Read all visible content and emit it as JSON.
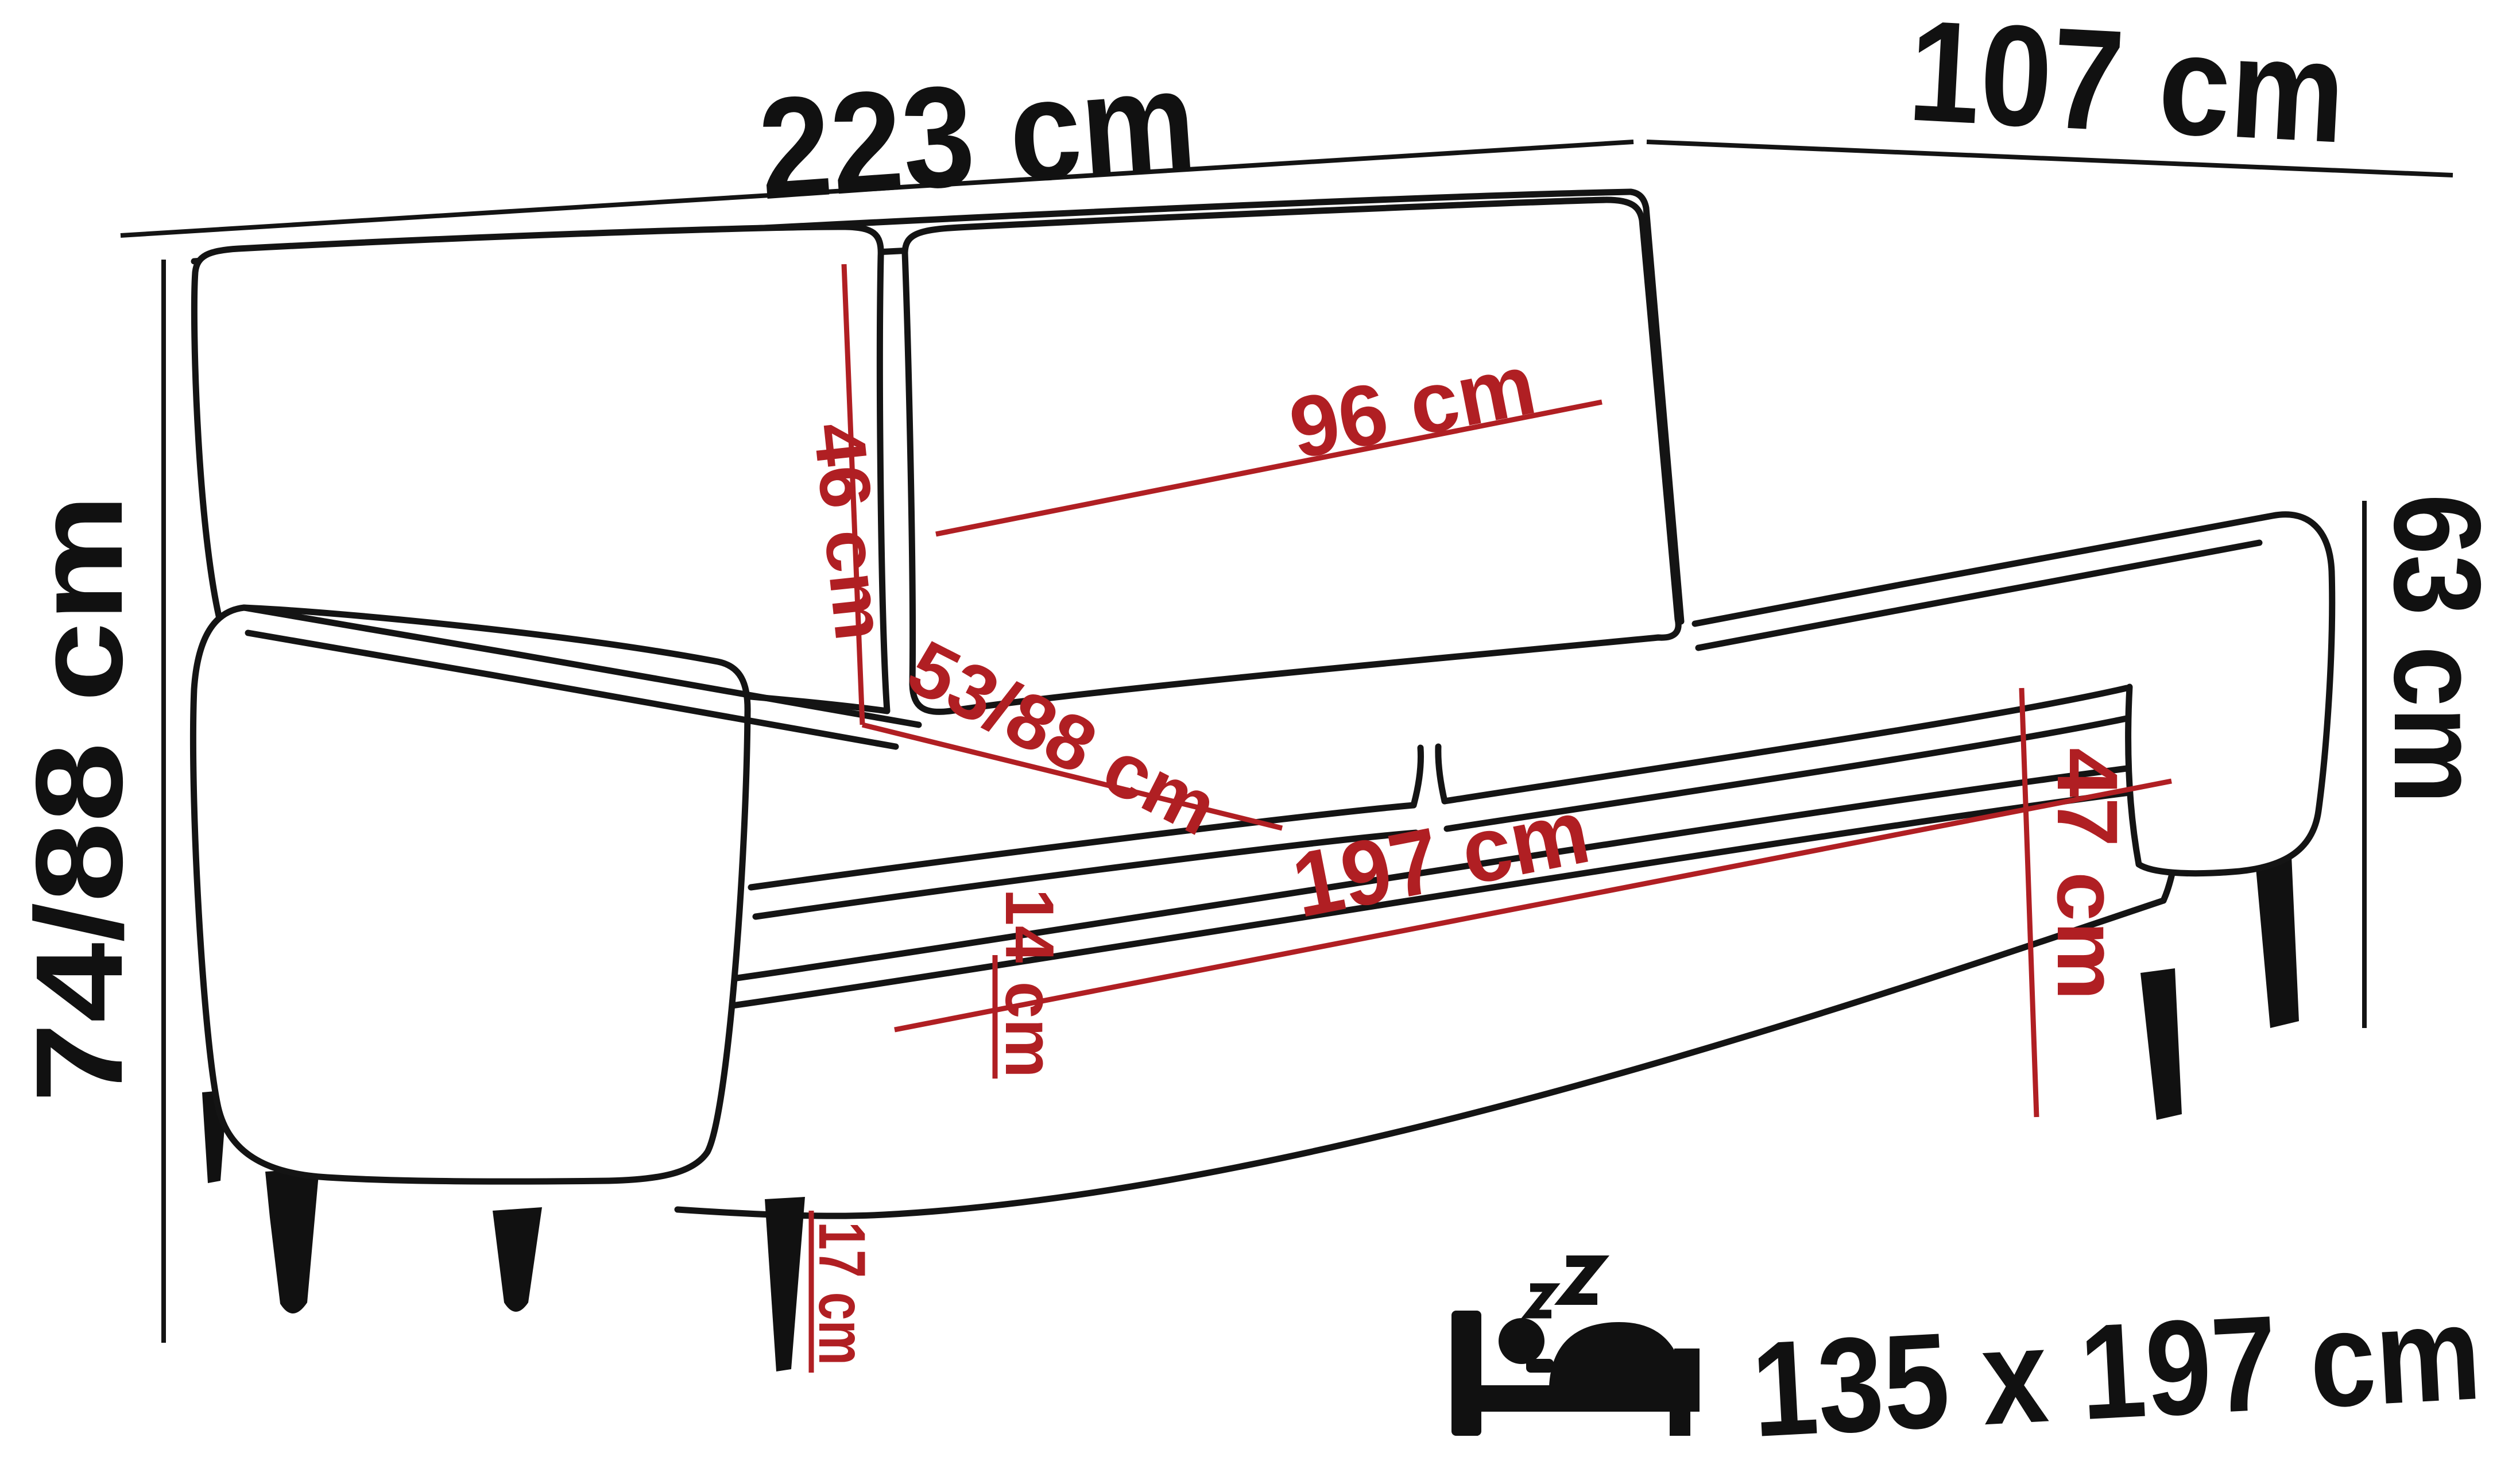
{
  "diagram": {
    "type": "sofa-dimension-drawing",
    "background": "#ffffff",
    "outline_color": "#141414",
    "dimension_color": "#b01f23",
    "overall": {
      "width": "223 cm",
      "depth": "107 cm",
      "height": "74/88 cm",
      "side_height": "63 cm"
    },
    "details": {
      "back_cushion_height": "46 cm",
      "back_cushion_width": "96 cm",
      "seat_depth": "53/88 cm",
      "seat_width": "197 cm",
      "base_height": "14 cm",
      "seat_height": "47 cm",
      "leg_height": "17 cm"
    },
    "sleeping_function": {
      "icon": "bed-sleep-icon",
      "size": "135 x 197 cm"
    }
  }
}
